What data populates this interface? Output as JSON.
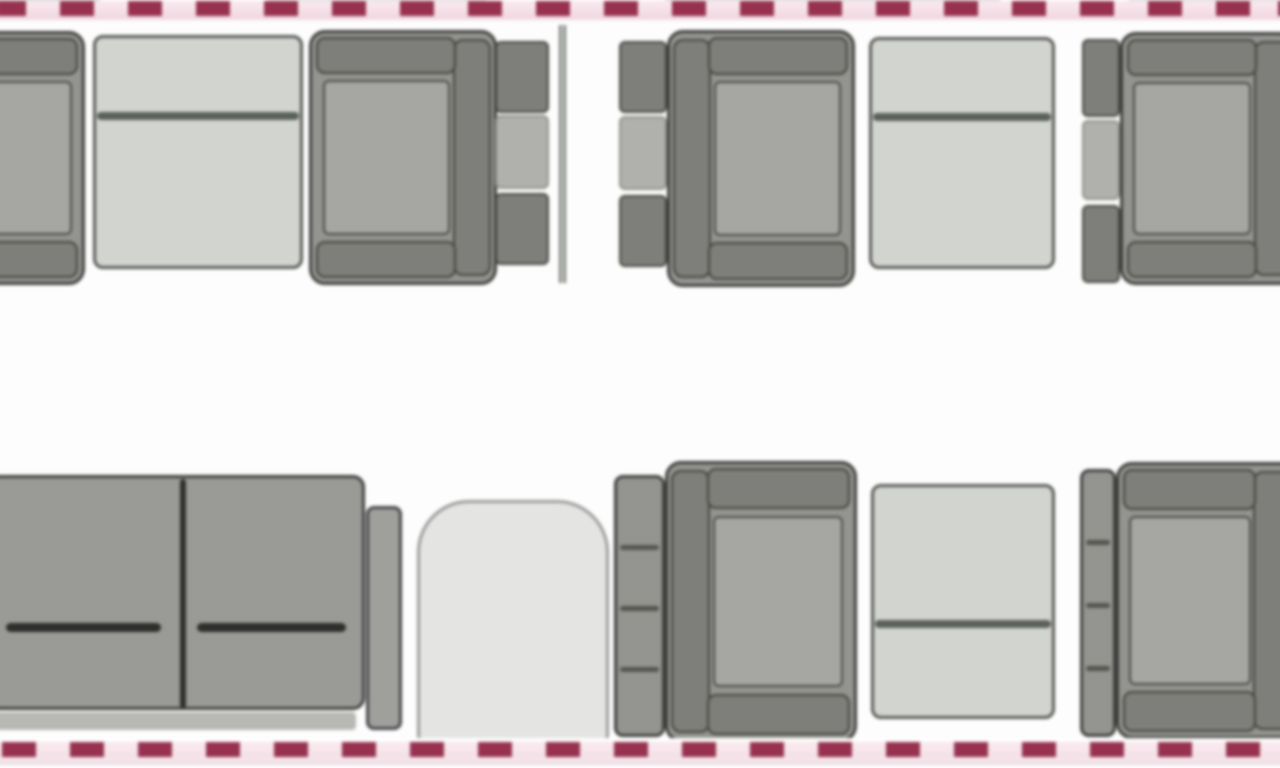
{
  "diagram": {
    "type": "aircraft-cabin-floorplan-top-view",
    "background": "#fdfdfd",
    "wall": {
      "dash_color": "#97314f",
      "dash_gap_color": "rgba(240,205,218,0.38)",
      "dash_width_px": 34,
      "dash_period_px": 68,
      "band_pink": "#efd6df"
    },
    "palette": {
      "seat_fill": "#949490",
      "seat_border": "#3e3e3c",
      "cushion_fill": "#a8a8a4",
      "bar_fill": "#7e7e7a",
      "bar_border": "#45453f",
      "table_fill": "#d2d4d0",
      "table_border": "#565854",
      "table_line": "#5a605a",
      "cabinet_fill": "#e4e4e2",
      "cabinet_border": "#9a9a98",
      "divan_fill": "#9a9a96",
      "dark_line": "#2e2e2c",
      "console_mid": "#b0b0ac",
      "divider": "#70736e"
    },
    "items": [
      {
        "name": "club-seat-1-partial",
        "kind": "seat",
        "x": -78,
        "y": 34,
        "w": 166,
        "h": 254,
        "back": "left"
      },
      {
        "name": "table-1",
        "kind": "table",
        "x": 96,
        "y": 38,
        "w": 210,
        "h": 234,
        "line_pos": 0.34
      },
      {
        "name": "club-seat-2",
        "kind": "seat",
        "x": 312,
        "y": 33,
        "w": 188,
        "h": 255,
        "back": "right"
      },
      {
        "name": "side-console-1",
        "kind": "console",
        "x": 498,
        "y": 44,
        "w": 54,
        "h": 224
      },
      {
        "name": "cabin-divider",
        "kind": "divider",
        "x": 562,
        "y": 28,
        "w": 7,
        "h": 258
      },
      {
        "name": "side-console-2",
        "kind": "console",
        "x": 622,
        "y": 44,
        "w": 48,
        "h": 226
      },
      {
        "name": "club-seat-3",
        "kind": "seat",
        "x": 670,
        "y": 33,
        "w": 188,
        "h": 257,
        "back": "left"
      },
      {
        "name": "table-2",
        "kind": "table",
        "x": 872,
        "y": 40,
        "w": 186,
        "h": 232,
        "line_pos": 0.34
      },
      {
        "name": "side-console-3",
        "kind": "console",
        "x": 1085,
        "y": 42,
        "w": 38,
        "h": 244
      },
      {
        "name": "club-seat-4-partial",
        "kind": "seat",
        "x": 1123,
        "y": 35,
        "w": 175,
        "h": 253,
        "back": "right"
      },
      {
        "name": "divan-sofa",
        "kind": "divan",
        "x": -10,
        "y": 478,
        "w": 415,
        "h": 260
      },
      {
        "name": "cabinet",
        "kind": "cabinet",
        "x": 420,
        "y": 503,
        "w": 192,
        "h": 245
      },
      {
        "name": "ottoman-1",
        "kind": "ottoman",
        "x": 617,
        "y": 478,
        "w": 51,
        "h": 262
      },
      {
        "name": "club-seat-5",
        "kind": "seat",
        "x": 668,
        "y": 464,
        "w": 192,
        "h": 281,
        "back": "left"
      },
      {
        "name": "table-3",
        "kind": "table",
        "x": 874,
        "y": 487,
        "w": 184,
        "h": 235,
        "line_pos": 0.6
      },
      {
        "name": "ottoman-2",
        "kind": "ottoman",
        "x": 1083,
        "y": 472,
        "w": 36,
        "h": 268
      },
      {
        "name": "club-seat-6-partial",
        "kind": "seat",
        "x": 1119,
        "y": 465,
        "w": 180,
        "h": 277,
        "back": "right"
      }
    ]
  }
}
